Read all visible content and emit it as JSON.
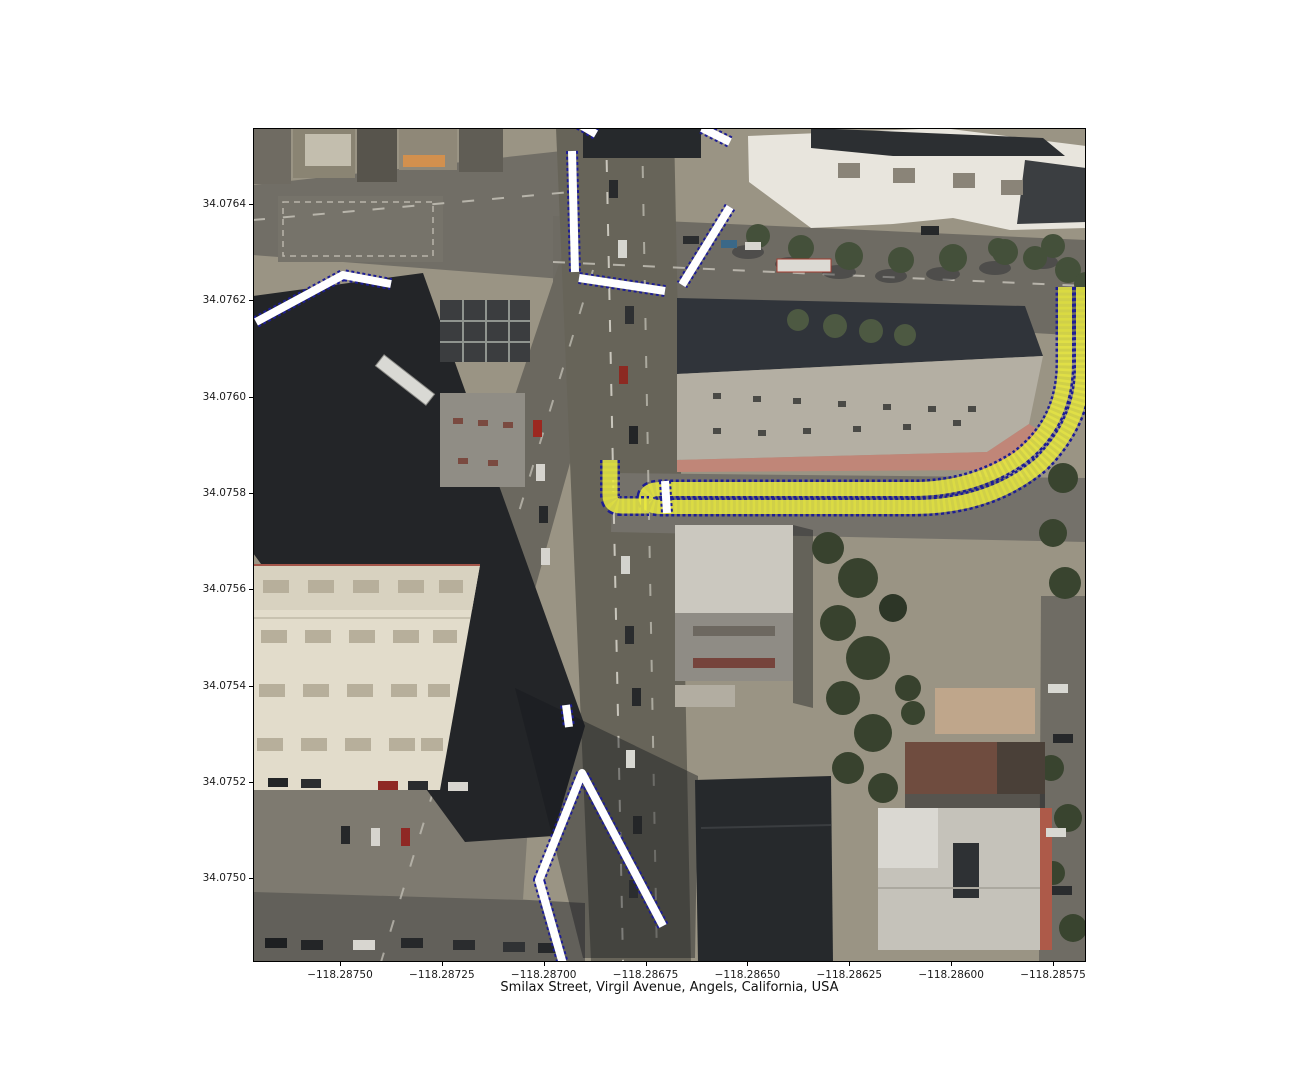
{
  "figure": {
    "xlabel": "Smilax Street, Virgil Avenue, Angels, California, USA",
    "x_axis": {
      "labels": [
        "−118.28750",
        "−118.28725",
        "−118.28700",
        "−118.28675",
        "−118.28650",
        "−118.28625",
        "−118.28600",
        "−118.28575"
      ],
      "first_px": 87,
      "step_px": 101.857
    },
    "y_axis": {
      "labels": [
        "34.0764",
        "34.0762",
        "34.0760",
        "34.0758",
        "34.0756",
        "34.0754",
        "34.0752",
        "34.0750"
      ],
      "first_px": 76,
      "step_px": 96.3
    },
    "plot_box": {
      "left": 253,
      "top": 128,
      "width": 833,
      "height": 834
    }
  },
  "map_overlays": {
    "border_color": "#1d1d94",
    "crosswalk_color": "#ffffff",
    "route_color": "#e9e93e",
    "route_opacity": 0.88,
    "dash": "3 2.6",
    "crosswalk_width": 8,
    "crosswalk_border_width": 12,
    "crosswalks": [
      {
        "name": "crosswalk-northwest",
        "points": [
          [
            3,
            194
          ],
          [
            90,
            147
          ],
          [
            138,
            156
          ]
        ]
      },
      {
        "name": "crosswalk-north-vertical",
        "points": [
          [
            319,
            23
          ],
          [
            322,
            144
          ]
        ]
      },
      {
        "name": "crosswalk-top-edge",
        "points": [
          [
            326,
            -4
          ],
          [
            343,
            6
          ]
        ]
      },
      {
        "name": "crosswalk-northeast-top",
        "points": [
          [
            449,
            0
          ],
          [
            477,
            14
          ]
        ]
      },
      {
        "name": "crosswalk-northeast-diagonal",
        "points": [
          [
            477,
            79
          ],
          [
            429,
            157
          ]
        ]
      },
      {
        "name": "crosswalk-east-horizontal",
        "points": [
          [
            326,
            150
          ],
          [
            412,
            163
          ]
        ]
      },
      {
        "name": "crosswalk-middle-dash",
        "points": [
          [
            313,
            577
          ],
          [
            316,
            599
          ]
        ]
      },
      {
        "name": "crosswalk-south-vee",
        "points": [
          [
            410,
            798
          ],
          [
            329,
            645
          ],
          [
            286,
            752
          ],
          [
            310,
            836
          ]
        ]
      },
      {
        "name": "route-start-marker",
        "points": [
          [
            412,
            353
          ],
          [
            414,
            385
          ]
        ]
      }
    ],
    "routes": [
      {
        "name": "route-out-and-back",
        "d": "M 812,159 L 812,235 Q 812,295 766,330 Q 720,361 660,361 L 408,361 Q 393,361 393,370 Q 393,379 408,379 L 660,379 Q 737,379 788,336 Q 830,294 830,240 L 830,159",
        "width": 14,
        "border_width": 19
      },
      {
        "name": "route-endpoint-hook",
        "d": "M 357,332 L 357,367 Q 357,378 368,378 L 396,378",
        "width": 15,
        "border_width": 20
      }
    ]
  }
}
